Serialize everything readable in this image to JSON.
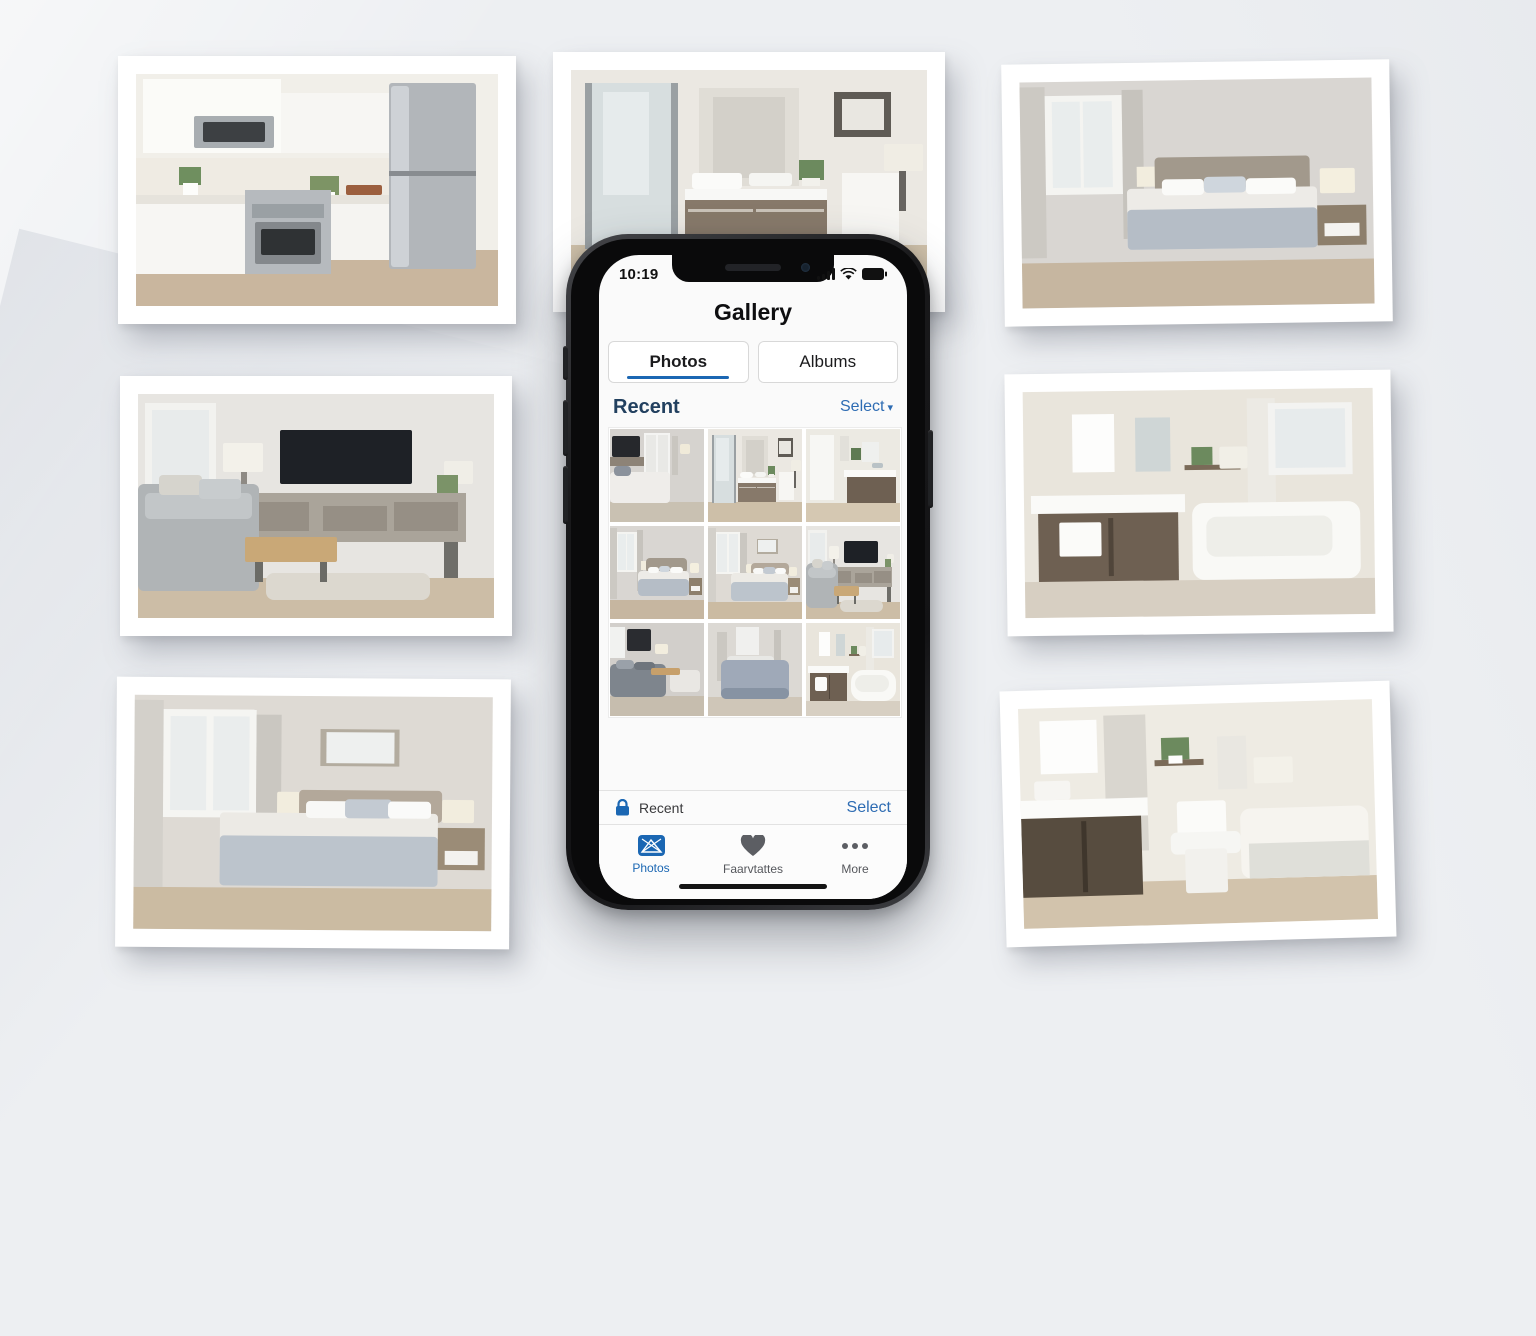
{
  "page": {
    "description": "Phone gallery app mockup surrounded by printed interior photos",
    "background": "#edeff2"
  },
  "colors": {
    "accent": "#1b67b3",
    "select_link": "#2e6cb3",
    "recent_header_text": "#22405f",
    "tabbar_inactive": "#55575c",
    "phone_frame": "#19191b"
  },
  "prints": [
    {
      "name": "kitchen-print",
      "label": "kitchen with stainless appliances",
      "scene": "kitchen"
    },
    {
      "name": "bathroom-shower-print",
      "label": "bathroom vanity with glass shower",
      "scene": "bathShower"
    },
    {
      "name": "bedroom-print",
      "label": "bedroom with window and gray bedding",
      "scene": "bedroom"
    },
    {
      "name": "living-room-print",
      "label": "living room with sofa and tv console",
      "scene": "living"
    },
    {
      "name": "bathroom-tub-print",
      "label": "bathroom with vanity and bathtub",
      "scene": "bathTub"
    },
    {
      "name": "bedroom-2-print",
      "label": "bedroom with framed art",
      "scene": "bedroom2"
    },
    {
      "name": "bathroom-toilet-print",
      "label": "bathroom with toilet and tub",
      "scene": "bathToilet"
    }
  ],
  "phone": {
    "statusbar": {
      "time": "10:19",
      "icons": [
        "signal-icon",
        "wifi-icon",
        "battery-icon"
      ]
    },
    "header": {
      "title": "Gallery"
    },
    "tabs": [
      {
        "label": "Photos",
        "active": true
      },
      {
        "label": "Albums",
        "active": false
      }
    ],
    "recent_section": {
      "title": "Recent",
      "select_label": "Select",
      "chevron": "▾"
    },
    "grid": {
      "photos": [
        {
          "name": "grid-photo-1",
          "label": "bedroom with wall tv",
          "scene": "bedTV"
        },
        {
          "name": "grid-photo-2",
          "label": "bathroom with glass shower",
          "scene": "bathShower"
        },
        {
          "name": "grid-photo-3",
          "label": "bathroom vanity",
          "scene": "vanityThumb"
        },
        {
          "name": "grid-photo-4",
          "label": "bedroom with lamp",
          "scene": "bedroom"
        },
        {
          "name": "grid-photo-5",
          "label": "bedroom with window",
          "scene": "bedroom2"
        },
        {
          "name": "grid-photo-6",
          "label": "living room with tv",
          "scene": "living"
        },
        {
          "name": "grid-photo-7",
          "label": "bedroom with gray sofa",
          "scene": "bedDark"
        },
        {
          "name": "grid-photo-8",
          "label": "bedroom with blue bedding",
          "scene": "bedBlue"
        },
        {
          "name": "grid-photo-9",
          "label": "bathroom with bathtub",
          "scene": "bathTub"
        }
      ]
    },
    "album_row": {
      "icon": "lock-icon",
      "label": "Recent",
      "select_label": "Select"
    },
    "tabbar": {
      "items": [
        {
          "label": "Photos",
          "icon": "photos-icon",
          "active": true
        },
        {
          "label": "Faarvtattes",
          "icon": "heart-icon",
          "active": false
        },
        {
          "label": "More",
          "icon": "ellipsis-icon",
          "active": false
        }
      ]
    }
  }
}
